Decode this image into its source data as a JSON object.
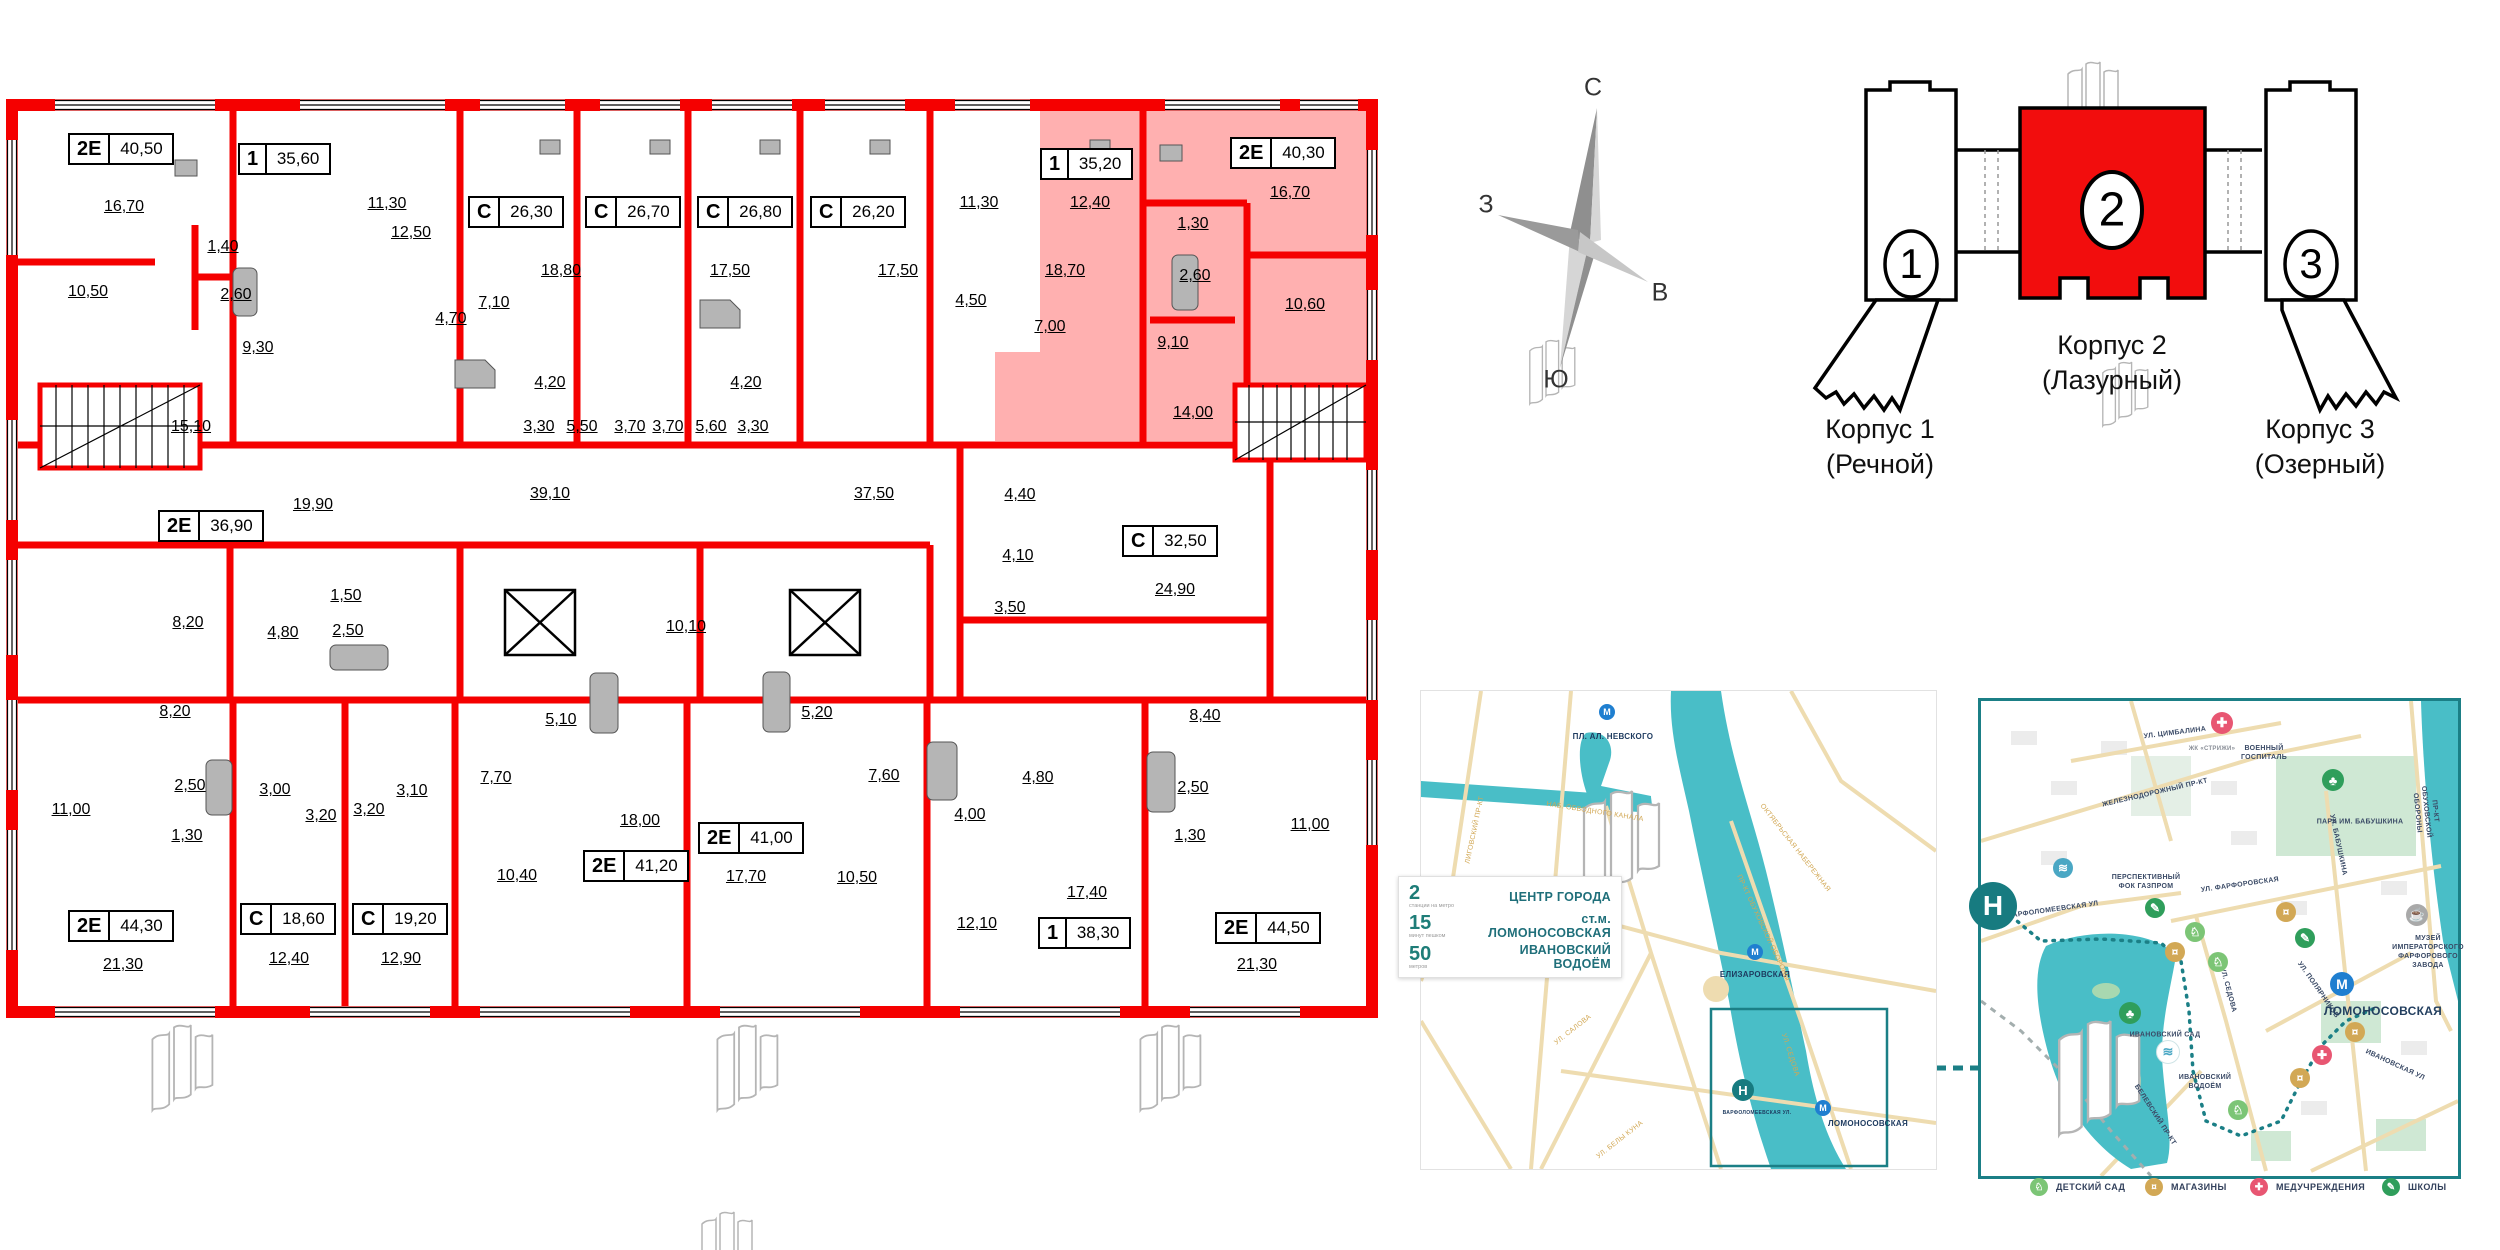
{
  "floor_plan": {
    "units": [
      {
        "type": "2Е",
        "area": "40,50",
        "x": 68,
        "y": 133,
        "hl": false
      },
      {
        "type": "1",
        "area": "35,60",
        "x": 238,
        "y": 143,
        "hl": false
      },
      {
        "type": "С",
        "area": "26,30",
        "x": 468,
        "y": 196,
        "hl": false
      },
      {
        "type": "С",
        "area": "26,70",
        "x": 585,
        "y": 196,
        "hl": false
      },
      {
        "type": "С",
        "area": "26,80",
        "x": 697,
        "y": 196,
        "hl": false
      },
      {
        "type": "С",
        "area": "26,20",
        "x": 810,
        "y": 196,
        "hl": false
      },
      {
        "type": "1",
        "area": "35,20",
        "x": 1040,
        "y": 148,
        "hl": false
      },
      {
        "type": "2Е",
        "area": "40,30",
        "x": 1230,
        "y": 137,
        "hl": true
      },
      {
        "type": "2Е",
        "area": "36,90",
        "x": 158,
        "y": 510,
        "hl": false
      },
      {
        "type": "С",
        "area": "32,50",
        "x": 1122,
        "y": 525,
        "hl": false
      },
      {
        "type": "2Е",
        "area": "44,30",
        "x": 68,
        "y": 910,
        "hl": false
      },
      {
        "type": "С",
        "area": "18,60",
        "x": 240,
        "y": 903,
        "hl": false
      },
      {
        "type": "С",
        "area": "19,20",
        "x": 352,
        "y": 903,
        "hl": false
      },
      {
        "type": "2Е",
        "area": "41,20",
        "x": 583,
        "y": 850,
        "hl": false
      },
      {
        "type": "2Е",
        "area": "41,00",
        "x": 698,
        "y": 822,
        "hl": false
      },
      {
        "type": "1",
        "area": "38,30",
        "x": 1038,
        "y": 917,
        "hl": false
      },
      {
        "type": "2Е",
        "area": "44,50",
        "x": 1215,
        "y": 912,
        "hl": false
      }
    ],
    "room_labels": [
      {
        "t": "16,70",
        "x": 124,
        "y": 207
      },
      {
        "t": "10,50",
        "x": 88,
        "y": 292
      },
      {
        "t": "1,40",
        "x": 223,
        "y": 247
      },
      {
        "t": "2,60",
        "x": 236,
        "y": 295
      },
      {
        "t": "9,30",
        "x": 258,
        "y": 348
      },
      {
        "t": "11,30",
        "x": 387,
        "y": 204
      },
      {
        "t": "12,50",
        "x": 411,
        "y": 233
      },
      {
        "t": "7,10",
        "x": 494,
        "y": 303
      },
      {
        "t": "4,70",
        "x": 451,
        "y": 319
      },
      {
        "t": "15,10",
        "x": 191,
        "y": 427
      },
      {
        "t": "18,80",
        "x": 561,
        "y": 271
      },
      {
        "t": "17,50",
        "x": 730,
        "y": 271
      },
      {
        "t": "17,50",
        "x": 898,
        "y": 271
      },
      {
        "t": "18,70",
        "x": 1065,
        "y": 271
      },
      {
        "t": "4,20",
        "x": 550,
        "y": 383
      },
      {
        "t": "3,30",
        "x": 539,
        "y": 427
      },
      {
        "t": "5,50",
        "x": 582,
        "y": 427
      },
      {
        "t": "3,70",
        "x": 630,
        "y": 427
      },
      {
        "t": "3,70",
        "x": 668,
        "y": 427
      },
      {
        "t": "5,60",
        "x": 711,
        "y": 427
      },
      {
        "t": "3,30",
        "x": 753,
        "y": 427
      },
      {
        "t": "4,20",
        "x": 746,
        "y": 383
      },
      {
        "t": "39,10",
        "x": 550,
        "y": 494
      },
      {
        "t": "37,50",
        "x": 874,
        "y": 494
      },
      {
        "t": "11,30",
        "x": 979,
        "y": 203
      },
      {
        "t": "12,40",
        "x": 1090,
        "y": 203
      },
      {
        "t": "4,50",
        "x": 971,
        "y": 301
      },
      {
        "t": "7,00",
        "x": 1050,
        "y": 327
      },
      {
        "t": "14,00",
        "x": 1193,
        "y": 413
      },
      {
        "t": "16,70",
        "x": 1290,
        "y": 193
      },
      {
        "t": "1,30",
        "x": 1193,
        "y": 224
      },
      {
        "t": "2,60",
        "x": 1195,
        "y": 276
      },
      {
        "t": "10,60",
        "x": 1305,
        "y": 305
      },
      {
        "t": "9,10",
        "x": 1173,
        "y": 343
      },
      {
        "t": "4,40",
        "x": 1020,
        "y": 495
      },
      {
        "t": "4,10",
        "x": 1018,
        "y": 556
      },
      {
        "t": "3,50",
        "x": 1010,
        "y": 608
      },
      {
        "t": "24,90",
        "x": 1175,
        "y": 590
      },
      {
        "t": "19,90",
        "x": 313,
        "y": 505
      },
      {
        "t": "8,20",
        "x": 188,
        "y": 623
      },
      {
        "t": "1,50",
        "x": 346,
        "y": 596
      },
      {
        "t": "2,50",
        "x": 348,
        "y": 631
      },
      {
        "t": "4,80",
        "x": 283,
        "y": 633
      },
      {
        "t": "8,20",
        "x": 175,
        "y": 712
      },
      {
        "t": "11,00",
        "x": 71,
        "y": 810
      },
      {
        "t": "2,50",
        "x": 190,
        "y": 786
      },
      {
        "t": "1,30",
        "x": 187,
        "y": 836
      },
      {
        "t": "3,00",
        "x": 275,
        "y": 790
      },
      {
        "t": "3,20",
        "x": 321,
        "y": 816
      },
      {
        "t": "3,10",
        "x": 412,
        "y": 791
      },
      {
        "t": "3,20",
        "x": 369,
        "y": 810
      },
      {
        "t": "21,30",
        "x": 123,
        "y": 965
      },
      {
        "t": "12,40",
        "x": 289,
        "y": 959
      },
      {
        "t": "12,90",
        "x": 401,
        "y": 959
      },
      {
        "t": "7,70",
        "x": 496,
        "y": 778
      },
      {
        "t": "5,10",
        "x": 561,
        "y": 720
      },
      {
        "t": "10,10",
        "x": 686,
        "y": 627
      },
      {
        "t": "18,00",
        "x": 640,
        "y": 821
      },
      {
        "t": "10,40",
        "x": 517,
        "y": 876
      },
      {
        "t": "17,70",
        "x": 746,
        "y": 877
      },
      {
        "t": "5,20",
        "x": 817,
        "y": 713
      },
      {
        "t": "7,60",
        "x": 884,
        "y": 776
      },
      {
        "t": "10,50",
        "x": 857,
        "y": 878
      },
      {
        "t": "4,80",
        "x": 1038,
        "y": 778
      },
      {
        "t": "4,00",
        "x": 970,
        "y": 815
      },
      {
        "t": "12,10",
        "x": 977,
        "y": 924
      },
      {
        "t": "17,40",
        "x": 1087,
        "y": 893
      },
      {
        "t": "2,50",
        "x": 1193,
        "y": 788
      },
      {
        "t": "1,30",
        "x": 1190,
        "y": 836
      },
      {
        "t": "8,40",
        "x": 1205,
        "y": 716
      },
      {
        "t": "11,00",
        "x": 1310,
        "y": 825
      },
      {
        "t": "21,30",
        "x": 1257,
        "y": 965
      }
    ]
  },
  "site_diagram": {
    "compass": {
      "north": "С",
      "south": "Ю",
      "west": "З",
      "east": "В"
    },
    "buildings": [
      {
        "num": "1",
        "title": "Корпус 1",
        "subtitle": "(Речной)",
        "highlighted": false
      },
      {
        "num": "2",
        "title": "Корпус 2",
        "subtitle": "(Лазурный)",
        "highlighted": true
      },
      {
        "num": "3",
        "title": "Корпус 3",
        "subtitle": "(Озерный)",
        "highlighted": false
      }
    ]
  },
  "overview_map": {
    "info_card": {
      "rows": [
        {
          "value": "2",
          "unit": "станции на метро",
          "label": "ЦЕНТР ГОРОДА"
        },
        {
          "value": "15",
          "unit": "минут пешком",
          "label": "ст.м. ЛОМОНОСОВСКАЯ"
        },
        {
          "value": "50",
          "unit": "метров",
          "label": "ИВАНОВСКИЙ ВОДОЁМ"
        }
      ]
    },
    "labels": [
      {
        "t": "ПЛ. АЛ. НЕВСКОГО",
        "x": 1613,
        "y": 737,
        "c": "navy"
      },
      {
        "t": "ЕЛИЗАРОВСКАЯ",
        "x": 1755,
        "y": 975,
        "c": "navy"
      },
      {
        "t": "ЛОМОНОСОВСКАЯ",
        "x": 1868,
        "y": 1124,
        "c": "navy"
      },
      {
        "t": "ВАРФОЛОМЕЕВСКАЯ УЛ.",
        "x": 1757,
        "y": 1113,
        "c": "navy",
        "s": 5
      },
      {
        "t": "ЛИГОВСКИЙ ПР-КТ",
        "x": 1475,
        "y": 830,
        "r": -78
      },
      {
        "t": "НАБ. ОБВОДНОГО КАНАЛА",
        "x": 1595,
        "y": 812,
        "r": 9
      },
      {
        "t": "ОКТЯБРЬСКАЯ НАБЕРЕЖНАЯ",
        "x": 1795,
        "y": 848,
        "r": 52
      },
      {
        "t": "ПР-КТ ОБУХОВСКОЙ ОБОРОНЫ",
        "x": 1763,
        "y": 928,
        "r": 65
      },
      {
        "t": "УЛ. САЛОВА",
        "x": 1573,
        "y": 1030,
        "r": -38
      },
      {
        "t": "УЛ. БЕЛЫ КУНА",
        "x": 1620,
        "y": 1140,
        "r": -38
      },
      {
        "t": "УЛ. СЕДОВА",
        "x": 1790,
        "y": 1055,
        "r": 72
      }
    ],
    "pois": [
      {
        "icon": "metro",
        "x": 1607,
        "y": 712,
        "c": "#1f7fd0",
        "d": 16
      },
      {
        "icon": "metro",
        "x": 1755,
        "y": 952,
        "c": "#1f7fd0",
        "d": 16
      },
      {
        "icon": "metro",
        "x": 1823,
        "y": 1108,
        "c": "#1f7fd0",
        "d": 16
      },
      {
        "icon": "logo",
        "x": 1743,
        "y": 1090,
        "c": "#177b80",
        "d": 22
      }
    ]
  },
  "detail_map": {
    "labels": [
      {
        "t": "УЛ. ЦИМБАЛИНА",
        "x": 2175,
        "y": 733,
        "r": -7,
        "c": "navy2"
      },
      {
        "t": "ЖК «СТРИЖИ»",
        "x": 2212,
        "y": 750,
        "c": "gray2"
      },
      {
        "t": "ВОЕННЫЙ\nГОСПИТАЛЬ",
        "x": 2264,
        "y": 753,
        "c": "navy2"
      },
      {
        "t": "ЖЕЛЕЗНОДОРОЖНЫЙ ПР-КТ",
        "x": 2155,
        "y": 793,
        "r": -13,
        "c": "navy2"
      },
      {
        "t": "ПАРК ИМ. БАБУШКИНА",
        "x": 2360,
        "y": 822,
        "c": "navy2"
      },
      {
        "t": "ПЕРСПЕКТИВНЫЙ\nФОК ГАЗПРОМ",
        "x": 2146,
        "y": 882,
        "c": "navy2"
      },
      {
        "t": "ВАРФОЛОМЕЕВСКАЯ УЛ",
        "x": 2053,
        "y": 910,
        "r": -8,
        "c": "navy2"
      },
      {
        "t": "УЛ. ФАРФОРОВСКАЯ",
        "x": 2240,
        "y": 885,
        "r": -8,
        "c": "navy2"
      },
      {
        "t": "УЛ. БАБУШКИНА",
        "x": 2338,
        "y": 845,
        "r": 78,
        "c": "navy2"
      },
      {
        "t": "УЛ. СЕДОВА",
        "x": 2228,
        "y": 990,
        "r": 75,
        "c": "navy2"
      },
      {
        "t": "УЛ. ПОЛЯРНИКОВ",
        "x": 2318,
        "y": 990,
        "r": 55,
        "c": "navy2"
      },
      {
        "t": "МУЗЕЙ\nИМПЕРАТОРСКОГО\nФАРФОРОВОГО\nЗАВОДА",
        "x": 2428,
        "y": 952,
        "c": "navy2"
      },
      {
        "t": "ЛОМОНОСОВСКАЯ",
        "x": 2383,
        "y": 1012,
        "c": "metro-big"
      },
      {
        "t": "ИВАНОВСКИЙ САД",
        "x": 2165,
        "y": 1035,
        "c": "navy2"
      },
      {
        "t": "ИВАНОВСКИЙ\nВОДОЁМ",
        "x": 2205,
        "y": 1082,
        "c": "navy2"
      },
      {
        "t": "ИВАНОВСКАЯ УЛ",
        "x": 2395,
        "y": 1065,
        "r": 25,
        "c": "navy2"
      },
      {
        "t": "БЕЛЕВСКИЙ ПР-КТ",
        "x": 2155,
        "y": 1115,
        "r": 57,
        "c": "navy2"
      },
      {
        "t": "ПР-КТ ОБУХОВСКОЙ ОБОРОНЫ",
        "x": 2426,
        "y": 812,
        "r": 84,
        "c": "navy2"
      }
    ],
    "pois": [
      {
        "icon": "med",
        "x": 2222,
        "y": 723,
        "c": "#e85672",
        "d": 22
      },
      {
        "icon": "tree",
        "x": 2333,
        "y": 780,
        "c": "#2f9e5b",
        "d": 22
      },
      {
        "icon": "pool",
        "x": 2063,
        "y": 868,
        "c": "#4aa7c4",
        "d": 20
      },
      {
        "icon": "school",
        "x": 2155,
        "y": 908,
        "c": "#2f9e5b",
        "d": 20
      },
      {
        "icon": "kind",
        "x": 2195,
        "y": 932,
        "c": "#7cc576",
        "d": 20
      },
      {
        "icon": "shop",
        "x": 2175,
        "y": 952,
        "c": "#d2a855",
        "d": 20
      },
      {
        "icon": "kind",
        "x": 2218,
        "y": 962,
        "c": "#7cc576",
        "d": 20
      },
      {
        "icon": "shop",
        "x": 2286,
        "y": 912,
        "c": "#d2a855",
        "d": 20
      },
      {
        "icon": "school",
        "x": 2305,
        "y": 938,
        "c": "#2f9e5b",
        "d": 20
      },
      {
        "icon": "museum",
        "x": 2417,
        "y": 915,
        "c": "#a9a9a9",
        "d": 22
      },
      {
        "icon": "metro",
        "x": 2342,
        "y": 984,
        "c": "#1f7fd0",
        "d": 24
      },
      {
        "icon": "tree",
        "x": 2130,
        "y": 1013,
        "c": "#2f9e5b",
        "d": 22
      },
      {
        "icon": "pond",
        "x": 2168,
        "y": 1052,
        "c": "#ffffff",
        "d": 22
      },
      {
        "icon": "shop",
        "x": 2355,
        "y": 1032,
        "c": "#d2a855",
        "d": 20
      },
      {
        "icon": "med",
        "x": 2322,
        "y": 1055,
        "c": "#e85672",
        "d": 20
      },
      {
        "icon": "shop",
        "x": 2300,
        "y": 1078,
        "c": "#d2a855",
        "d": 20
      },
      {
        "icon": "kind",
        "x": 2238,
        "y": 1110,
        "c": "#7cc576",
        "d": 20
      },
      {
        "icon": "logo",
        "x": 1993,
        "y": 906,
        "c": "#177b80",
        "d": 48
      }
    ],
    "legend": [
      {
        "icon": "kind",
        "label": "ДЕТСКИЙ САД",
        "c": "#7cc576",
        "x": 2030
      },
      {
        "icon": "shop",
        "label": "МАГАЗИНЫ",
        "c": "#d2a855",
        "x": 2145
      },
      {
        "icon": "med",
        "label": "МЕДУЧРЕЖДЕНИЯ",
        "c": "#e85672",
        "x": 2250
      },
      {
        "icon": "school",
        "label": "ШКОЛЫ",
        "c": "#2f9e5b",
        "x": 2382
      }
    ]
  },
  "colors": {
    "wall_red": "#f50000",
    "highlight_pink": "rgba(255,80,80,0.45)",
    "teal": "#1b7f86",
    "water": "#49bec7",
    "road_tan": "#eedcb0",
    "navy": "#1d3a5f"
  }
}
